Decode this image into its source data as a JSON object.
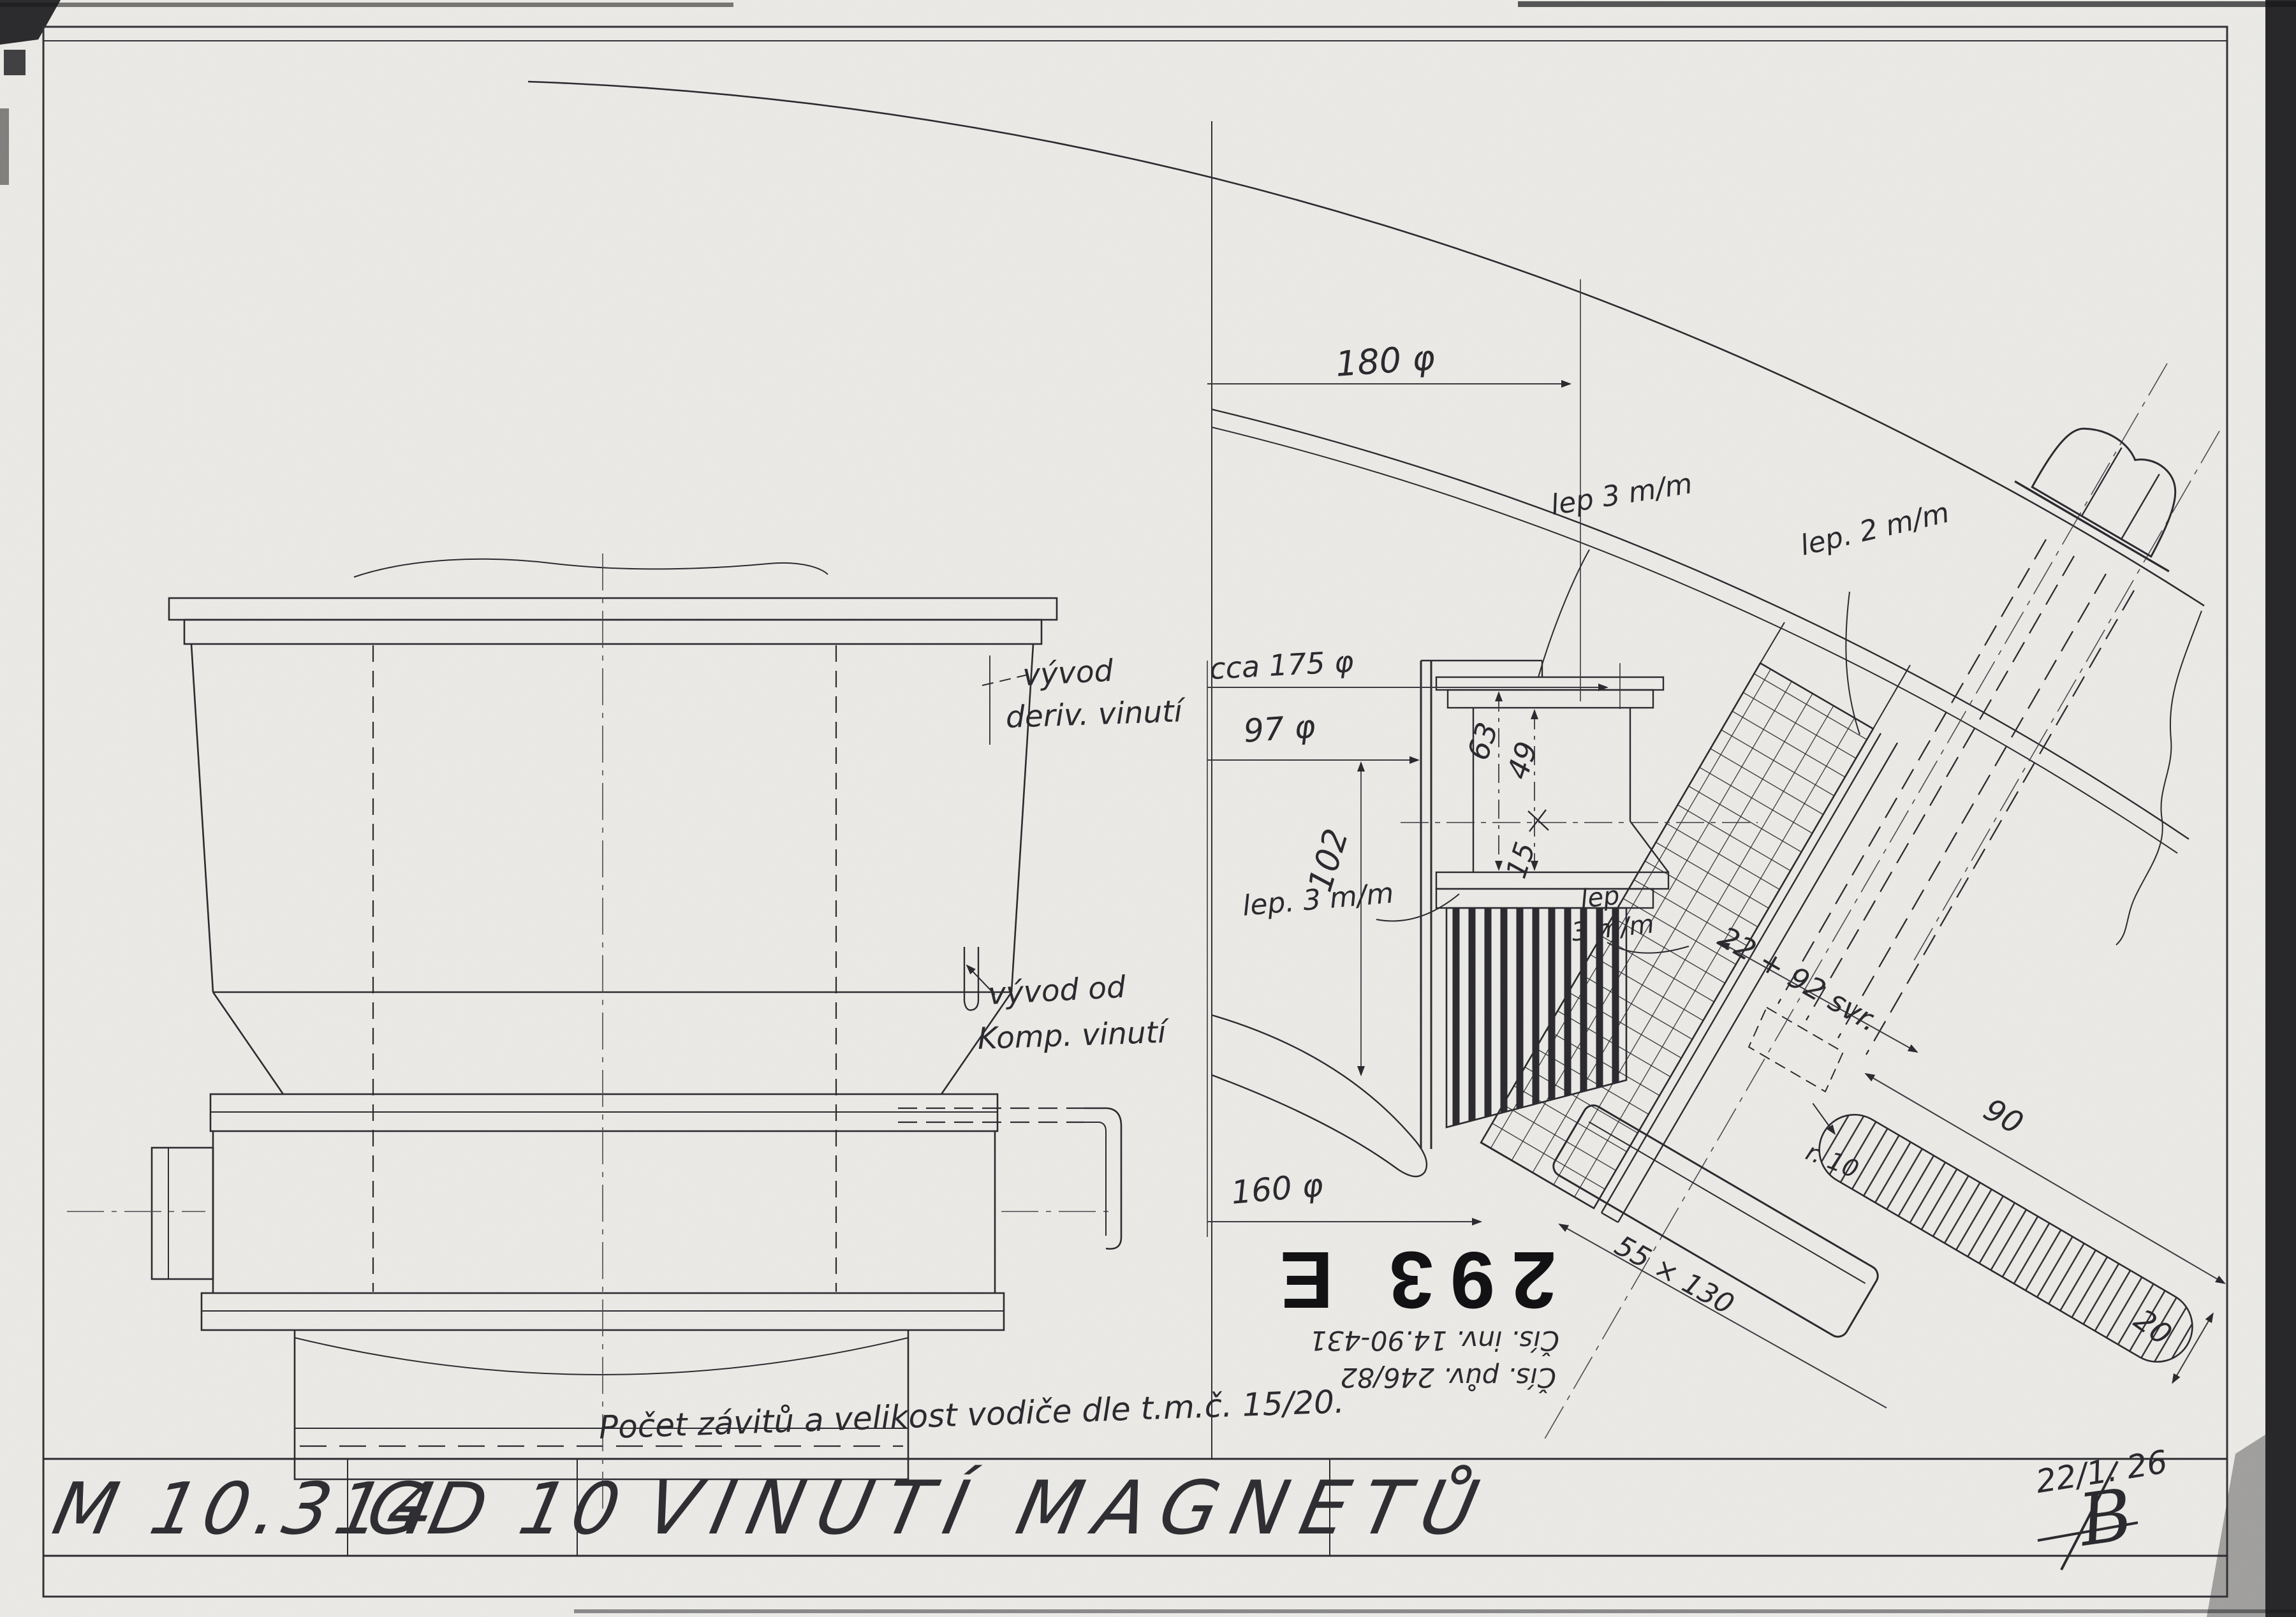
{
  "sheet": {
    "paper_color": "#edece8",
    "ink_color": "#2b2b30",
    "title_block": {
      "drawing_number": "M 10.314",
      "model_code": "GD 10",
      "title": "VINUTÍ MAGNETŮ",
      "date": "22/1. 26",
      "signature": "B"
    },
    "note": "Počet závitů a velikost vodiče dle t.m.č. 15/20.",
    "stamp": {
      "number": "293 E",
      "inventory_line": "Čís. inv. 14.90-431",
      "original_line": "Čís. pův. 246/82"
    }
  },
  "labels": {
    "lead_derivation": {
      "line1": "vývod",
      "line2": "deriv. vinutí"
    },
    "lead_compensation": {
      "line1": "vývod od",
      "line2": "Komp. vinutí"
    }
  },
  "dimensions": {
    "dia180": "180 φ",
    "dia175": "cca 175 φ",
    "dia97": "97 φ",
    "dia160": "160 φ",
    "len102": "102",
    "len63": "63",
    "len49": "49",
    "len15": "15",
    "glue3_top": "lep 3 m/m",
    "glue2": "lep. 2 m/m",
    "glue3_left": "lep. 3 m/m",
    "glue3_small_line1": "lep",
    "glue3_small_line2": "3 m/m",
    "winding_turns": "22 + 92 svr.",
    "shoe_size": "55 × 130",
    "slot_length": "90",
    "slot_width": "20",
    "slot_radius": "r. 10"
  }
}
